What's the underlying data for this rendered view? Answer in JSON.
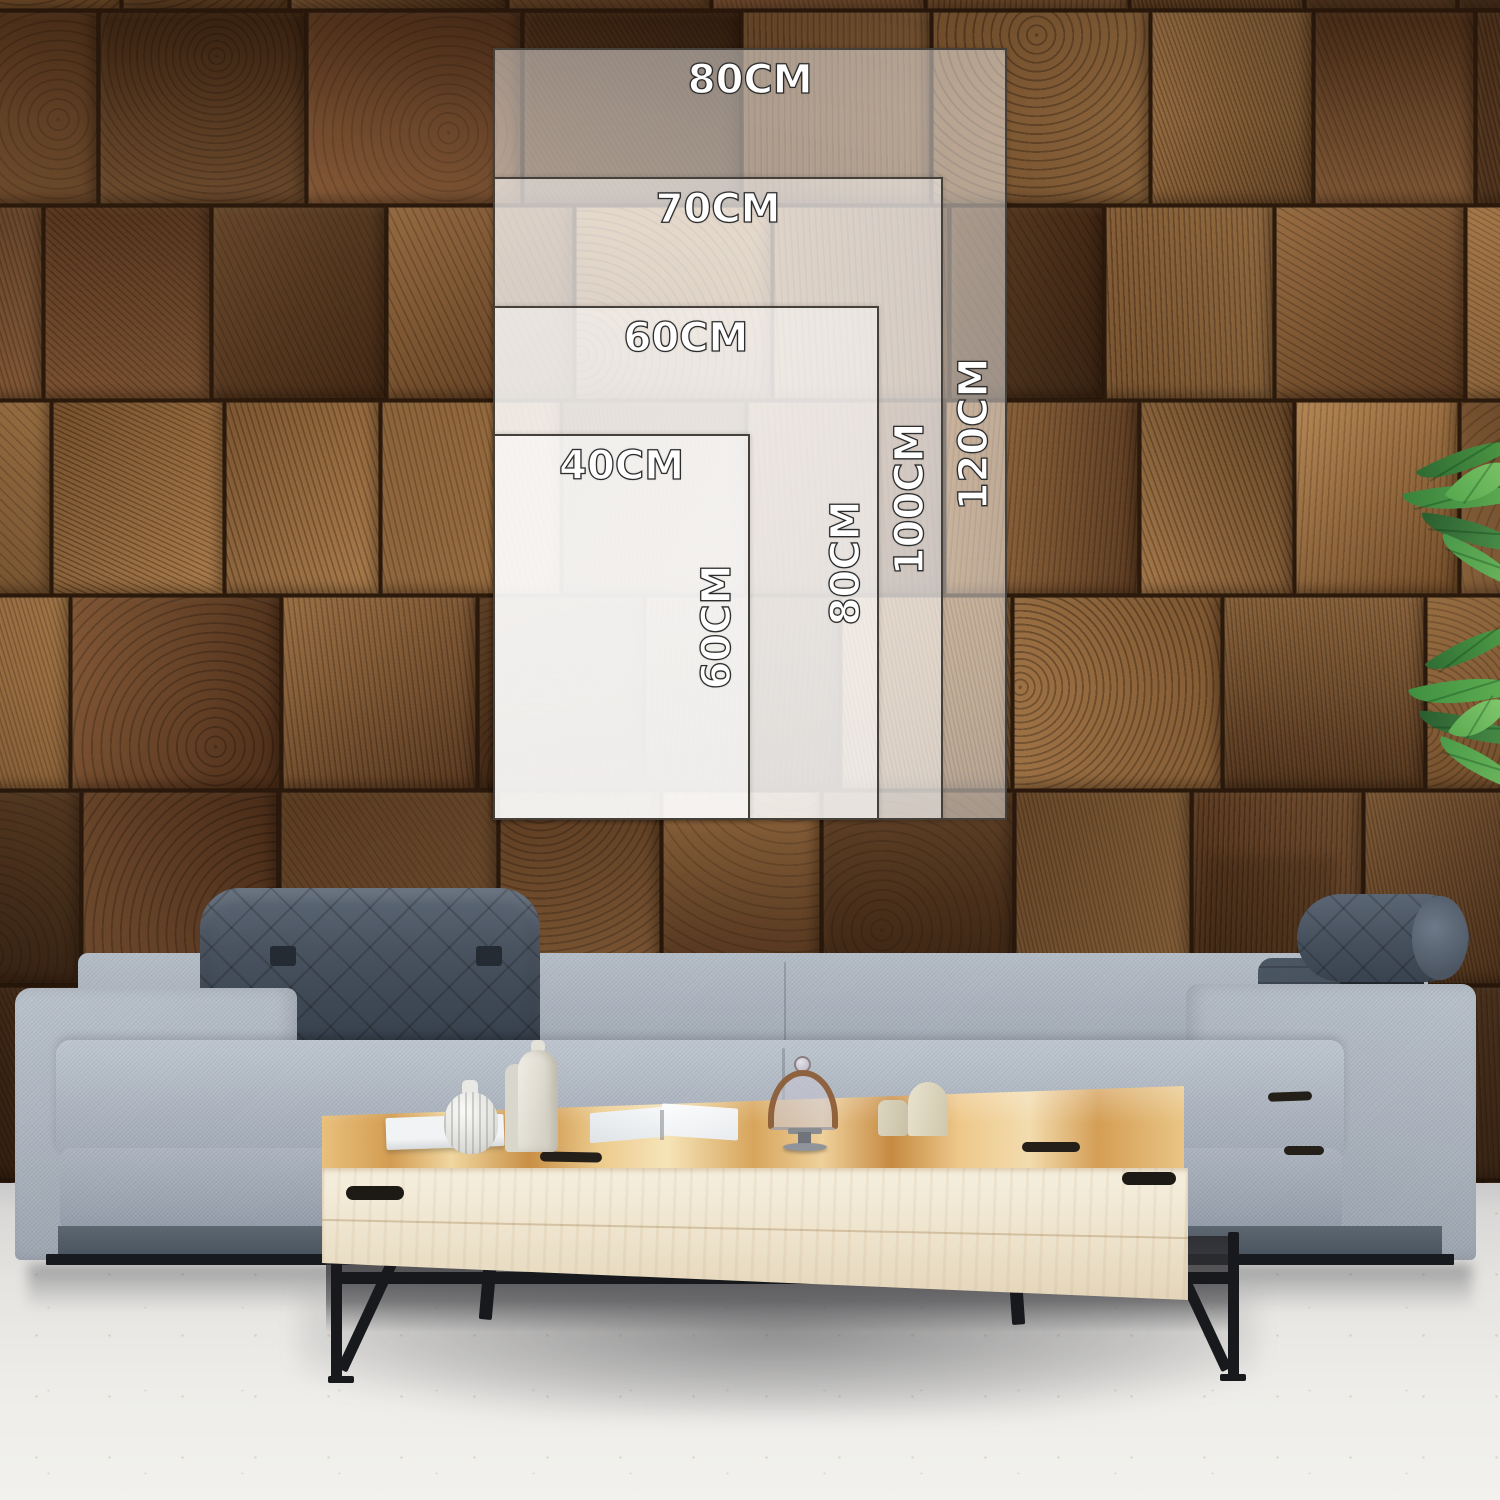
{
  "size_chart": {
    "unit": "CM",
    "anchor": {
      "left_px": 493,
      "bottom_px": 820,
      "px_per_cm": 6.43
    },
    "overlay_fill": "rgba(255,255,255,0.47)",
    "border_color": "#46403a",
    "label_color": "#ffffff",
    "label_outline": "#2d2d2d",
    "sizes": [
      {
        "width_cm": 80,
        "height_cm": 120,
        "width_label": "80CM",
        "height_label": "120CM"
      },
      {
        "width_cm": 70,
        "height_cm": 100,
        "width_label": "70CM",
        "height_label": "100CM"
      },
      {
        "width_cm": 60,
        "height_cm": 80,
        "width_label": "60CM",
        "height_label": "80CM"
      },
      {
        "width_cm": 40,
        "height_cm": 60,
        "width_label": "40CM",
        "height_label": "60CM"
      }
    ]
  },
  "scene": {
    "wall_wood_palette": [
      "#6b4426",
      "#7c5530",
      "#8a5f36",
      "#5a3a20",
      "#96693c",
      "#4e3019",
      "#75492a",
      "#a87948"
    ],
    "sofa_fabric": "#aab2bd",
    "sofa_dark_cushion": "#46505c",
    "sofa_base": "#515b65",
    "sofa_rail": "#171a1e",
    "table_top_wood": "#e3b877",
    "table_front_wood": "#f2e9d6",
    "table_metal": "#17191d",
    "floor": "#e9e8e5",
    "plant_green": "#3f8f41"
  }
}
